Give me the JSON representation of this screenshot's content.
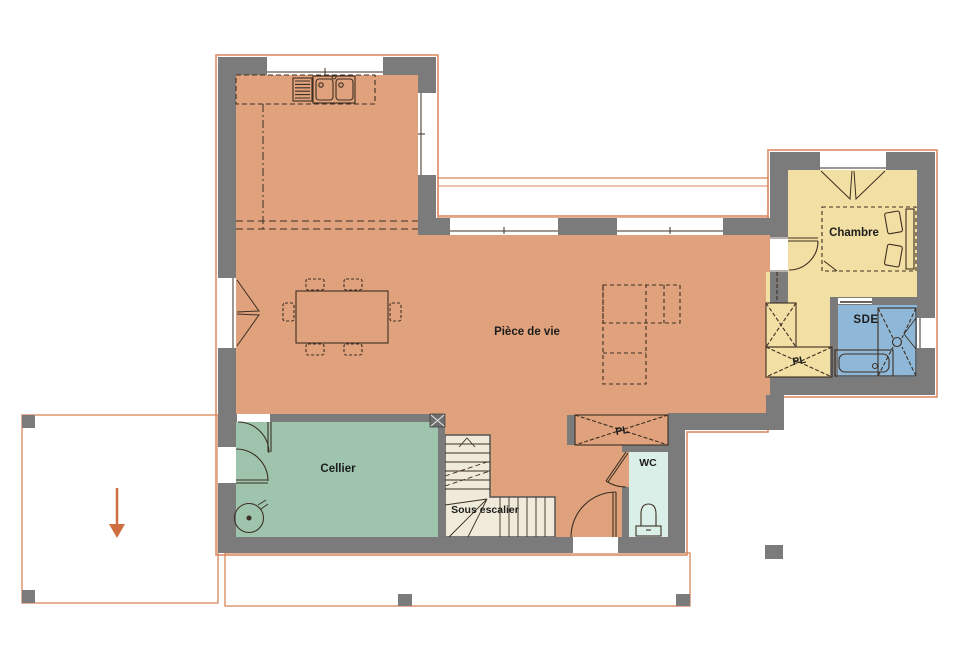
{
  "rooms": {
    "living": {
      "label": "Pièce de vie"
    },
    "bedroom": {
      "label": "Chambre"
    },
    "shower_room": {
      "label": "SDE"
    },
    "cellar": {
      "label": "Cellier"
    },
    "toilet": {
      "label": "WC"
    },
    "closet_hall": {
      "label": "PL"
    },
    "closet_bedroom": {
      "label": "PL"
    },
    "under_stairs": {
      "label": "Sous escalier"
    }
  },
  "colors": {
    "wall": "#7b7b7b",
    "living_floor": "#dfa27c",
    "bedroom_floor": "#f2dfa3",
    "shower_floor": "#8fb8d8",
    "cellar_floor": "#9ec4ae",
    "wc_floor": "#daefe7",
    "stairs_floor": "#efeada",
    "outline": "#d9865c",
    "arrow": "#cf6f3f",
    "furniture_line": "#3d2f23",
    "background": "#ffffff"
  },
  "features": [
    "kitchen-sink",
    "dish-drainer",
    "dining-table",
    "sofa",
    "double-bed",
    "wardrobe",
    "shower",
    "washbasin",
    "toilet",
    "water-heater",
    "staircase",
    "carport",
    "terrace",
    "entrance-arrow"
  ]
}
